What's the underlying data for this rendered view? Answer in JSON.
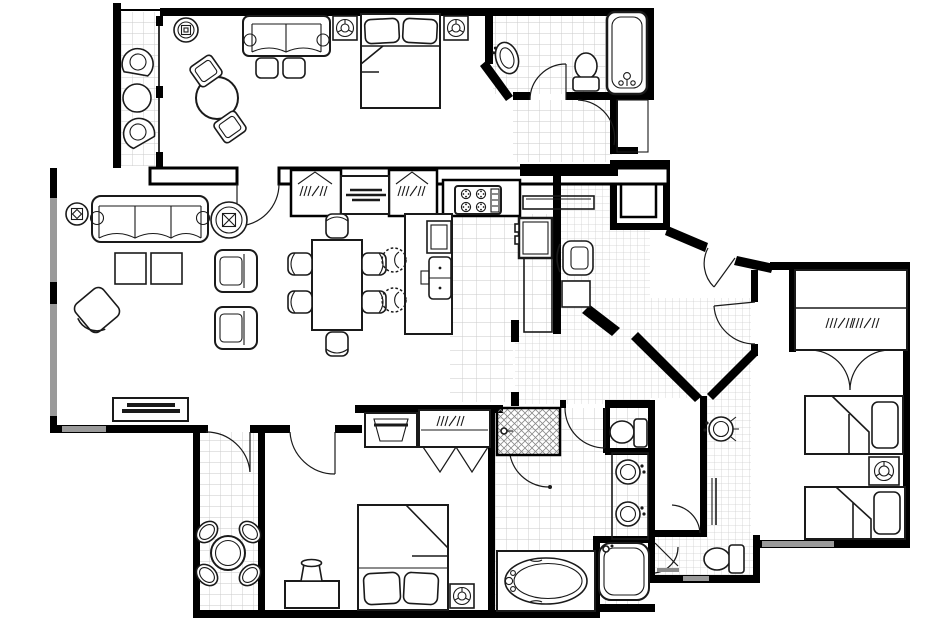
{
  "meta": {
    "type": "floor-plan",
    "style": "black-line architectural drawing, no text labels"
  },
  "palette": {
    "wall": "#000000",
    "floor": "#ffffff",
    "tile_line": "#c9c9c9",
    "tile_line_fine": "#cfcfcf",
    "window": "#9a9a9a",
    "furniture_line": "#1a1a1a",
    "hatch": "#8a8a8a"
  },
  "rooms": [
    {
      "id": "balcony-top",
      "floor": "tile",
      "furniture": [
        "lounge-chair",
        "lounge-chair",
        "round-patio-table"
      ]
    },
    {
      "id": "sitting-room",
      "floor": "carpet",
      "furniture": [
        "ceiling-light",
        "loveseat",
        "ottoman",
        "ottoman",
        "round-table",
        "side-chair",
        "side-chair"
      ]
    },
    {
      "id": "queen-bedroom-top",
      "floor": "carpet",
      "furniture": [
        "nightstand-lamp",
        "queen-bed",
        "nightstand-lamp"
      ]
    },
    {
      "id": "bathroom-top",
      "floor": "tile",
      "furniture": [
        "pedestal-sink",
        "toilet",
        "bathtub"
      ]
    },
    {
      "id": "hallway-top",
      "floor": "tile",
      "furniture": []
    },
    {
      "id": "utility-closet",
      "floor": "none",
      "furniture": [
        "equipment-cabinet"
      ]
    },
    {
      "id": "living-room",
      "floor": "carpet",
      "furniture": [
        "table-lamp",
        "sofa",
        "round-end-table-lamp",
        "coffee-table",
        "coffee-table",
        "swivel-chair",
        "armchair",
        "armchair",
        "tv-console"
      ]
    },
    {
      "id": "dining-area",
      "floor": "carpet",
      "furniture": [
        "dining-table",
        "dining-chair",
        "dining-chair",
        "dining-chair",
        "dining-chair",
        "dining-chair",
        "dining-chair"
      ]
    },
    {
      "id": "kitchen",
      "floor": "tile",
      "furniture": [
        "closet",
        "buffet-counter",
        "closet",
        "cooktop",
        "island",
        "island-sink",
        "bar-stool",
        "bar-stool",
        "refrigerator",
        "counter",
        "wall-shelf"
      ]
    },
    {
      "id": "foyer",
      "floor": "tile",
      "furniture": [
        "desk-chair",
        "side-table",
        "entry-door"
      ]
    },
    {
      "id": "master-bedroom",
      "floor": "carpet",
      "furniture": [
        "tv-cabinet",
        "bifold-closet",
        "queen-bed",
        "desk",
        "desk-lamp",
        "ceiling-lamp"
      ]
    },
    {
      "id": "balcony-bottom",
      "floor": "tile",
      "furniture": [
        "round-patio-table",
        "patio-chair",
        "patio-chair",
        "patio-chair",
        "patio-chair"
      ]
    },
    {
      "id": "master-bathroom",
      "floor": "tile",
      "furniture": [
        "shower",
        "toilet",
        "double-vanity-sink",
        "double-vanity-sink",
        "oval-tub",
        "soaking-tub"
      ]
    },
    {
      "id": "twin-bathroom",
      "floor": "tile",
      "furniture": [
        "pedestal-sink",
        "mirror-counter",
        "toilet"
      ]
    },
    {
      "id": "twin-bedroom",
      "floor": "carpet",
      "furniture": [
        "closet",
        "twin-bed",
        "nightstand-lamp",
        "twin-bed"
      ]
    }
  ]
}
